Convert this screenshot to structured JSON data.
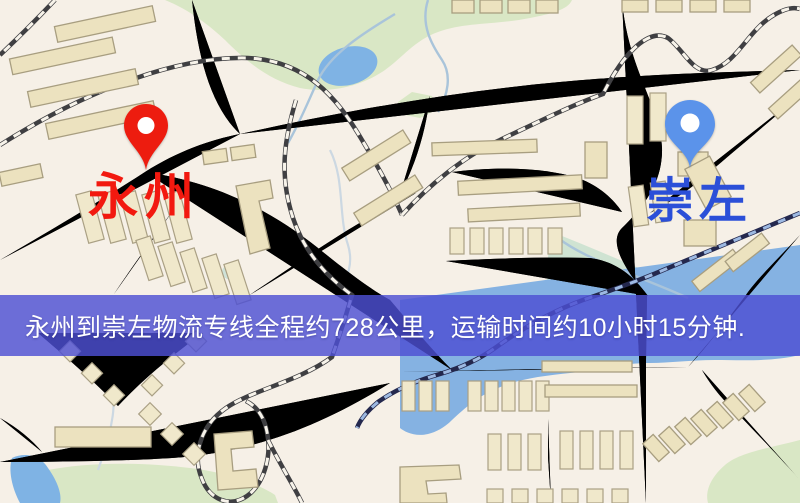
{
  "banner": {
    "text": "永州到崇左物流专线全程约728公里，运输时间约10小时15分钟.",
    "background_color": "#4d4fd3",
    "text_color": "#ffffff"
  },
  "markers": {
    "origin": {
      "name": "永州",
      "pin_color": "#ed1c0f",
      "label_color": "#f2190f"
    },
    "destination": {
      "name": "崇左",
      "pin_color": "#5b93ea",
      "label_color": "#2b4fd8"
    }
  },
  "route": {
    "distance_km": "728",
    "duration": "10小时15分钟"
  },
  "map_colors": {
    "background": "#f6f0e7",
    "road_fill": "#f8da84",
    "road_casing": "#e6bc66",
    "building": "#ece2bf",
    "park_green": "#d9e7c5",
    "water_blue": "#85b2e2",
    "railway": "#3f3f42"
  }
}
